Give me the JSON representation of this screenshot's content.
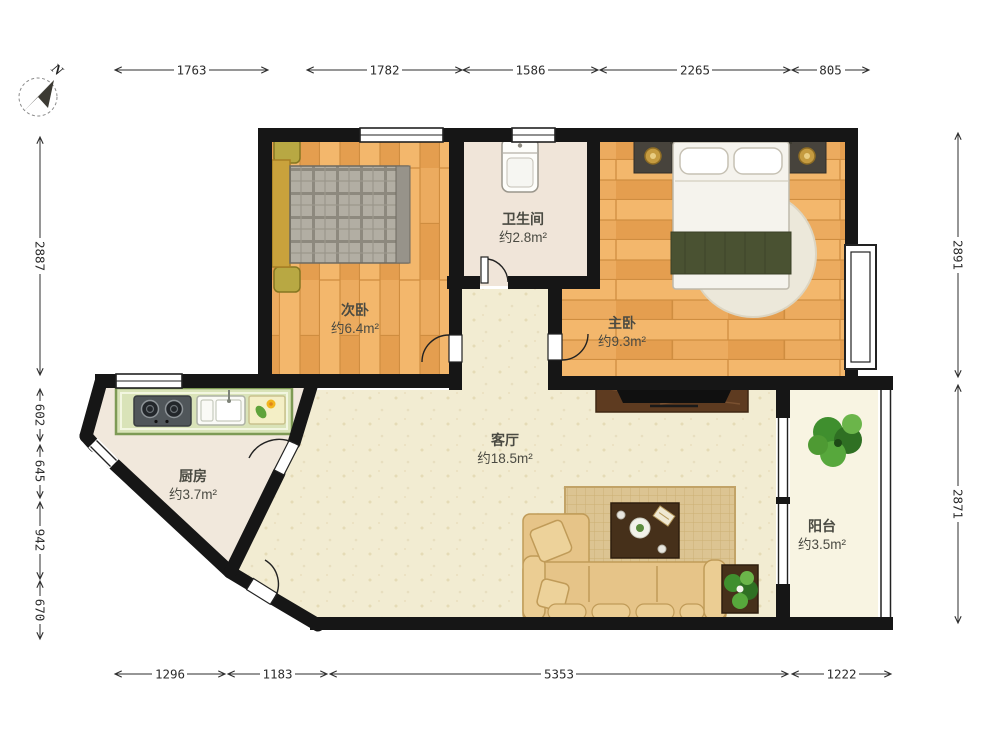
{
  "compass": {
    "north_label": "N"
  },
  "rooms": {
    "second_bedroom": {
      "name": "次卧",
      "area": "约6.4m²"
    },
    "bathroom": {
      "name": "卫生间",
      "area": "约2.8m²"
    },
    "master_bedroom": {
      "name": "主卧",
      "area": "约9.3m²"
    },
    "kitchen": {
      "name": "厨房",
      "area": "约3.7m²"
    },
    "living_room": {
      "name": "客厅",
      "area": "约18.5m²"
    },
    "balcony": {
      "name": "阳台",
      "area": "约3.5m²"
    }
  },
  "dims": {
    "top": [
      "1763",
      "1782",
      "1586",
      "2265",
      "805"
    ],
    "left": [
      "2887",
      "602",
      "645",
      "942",
      "670"
    ],
    "right": [
      "2891",
      "2871"
    ],
    "bottom": [
      "1296",
      "1183",
      "5353",
      "1222"
    ]
  },
  "colors": {
    "wall": "#161616",
    "wood_floor": "#ECAB5F",
    "cream_floor": "#F2ECD2",
    "kitchen_counter_green": "#D9E3B8",
    "blanket_olive": "#4A5232",
    "sofa_tan": "#E6C488",
    "plant_green": "#4E9A33"
  }
}
